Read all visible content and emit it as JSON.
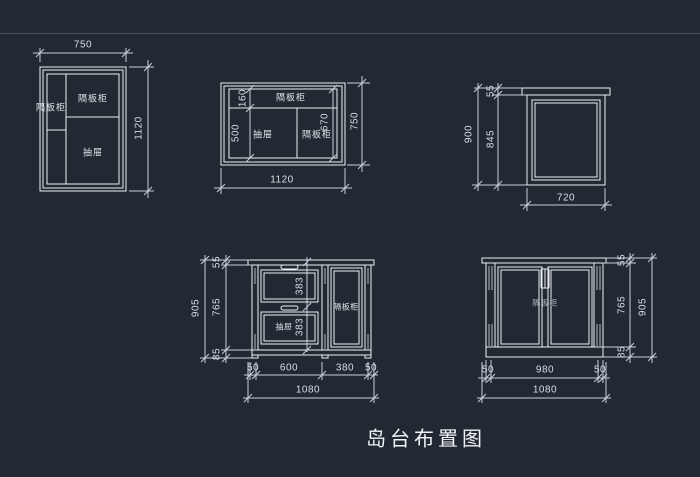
{
  "title": "岛台布置图",
  "colors": {
    "background": "#212932",
    "line": "#eef1f4",
    "dim_line": "#c9d0d9",
    "separator": "#4a5168"
  },
  "plan_left": {
    "dim_width": "750",
    "dim_height": "1120",
    "label_side_shelf": "隔板柜",
    "label_top_shelf": "隔板柜",
    "label_drawer": "抽屉"
  },
  "plan_middle": {
    "dim_bottom": "1120",
    "dim_right": "750",
    "dim_strip": "160",
    "dim_left_inner": "500",
    "dim_right_inner": "670",
    "label_top_shelf": "隔板柜",
    "label_drawer": "抽屉",
    "label_right_shelf": "隔板柜"
  },
  "elev_top_right": {
    "dim_total_height": "900",
    "dim_counter": "55",
    "dim_body": "845",
    "dim_width": "720"
  },
  "elev_bottom_left": {
    "dim_total_height": "905",
    "dim_counter": "55",
    "dim_body": "765",
    "dim_base": "85",
    "dim_drawer_top": "383",
    "dim_drawer_bottom": "383",
    "dim_seg1": "50",
    "dim_seg2": "600",
    "dim_seg3": "380",
    "dim_seg4": "50",
    "dim_total_width": "1080",
    "label_drawer": "抽屉",
    "label_shelf": "隔板柜"
  },
  "elev_bottom_right": {
    "dim_total_height": "905",
    "dim_counter": "55",
    "dim_body": "765",
    "dim_base": "85",
    "dim_seg1": "50",
    "dim_seg2": "980",
    "dim_seg3": "50",
    "dim_total_width": "1080",
    "label_shelf": "隔板柜"
  }
}
